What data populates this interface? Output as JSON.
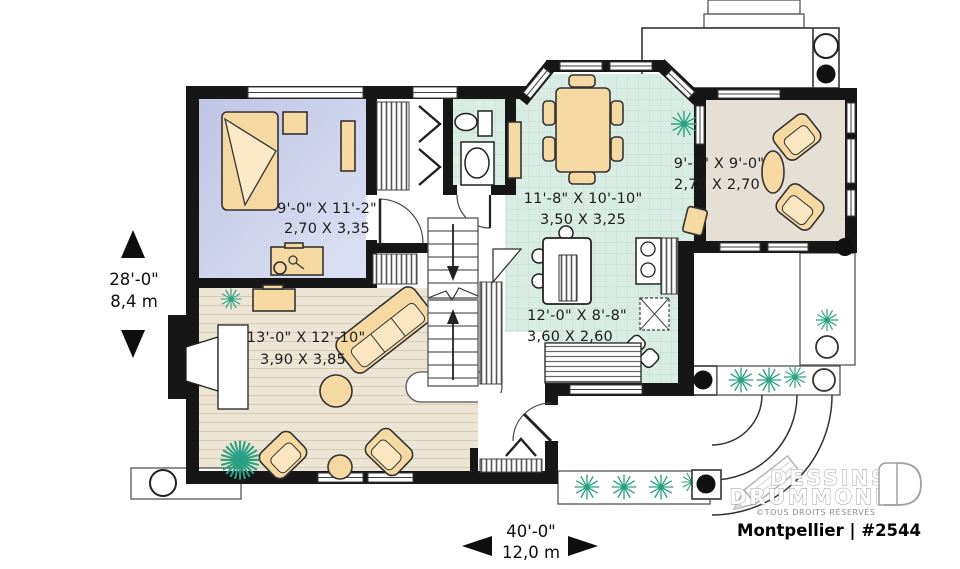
{
  "plan": {
    "title": "Montpellier | #2544",
    "brand": {
      "name_line1": "DESSINS",
      "name_line2": "DRUMMOND",
      "copyright": "©TOUS DROITS RÉSERVÉS"
    },
    "rooms": {
      "bedroom": {
        "imperial": "9'-0\" X 11'-2\"",
        "metric": "2,70 X 3,35"
      },
      "dining": {
        "imperial": "11'-8\" X 10'-10\"",
        "metric": "3,50 X 3,25"
      },
      "sunroom": {
        "imperial": "9'-0\" X 9'-0\"",
        "metric": "2,70 X 2,70"
      },
      "kitchen": {
        "imperial": "12'-0\" X 8'-8\"",
        "metric": "3,60 X 2,60"
      },
      "living": {
        "imperial": "13'-0\" X 12'-10\"",
        "metric": "3,90 X 3,85"
      }
    },
    "overall_dimensions": {
      "depth": {
        "imperial": "28'-0\"",
        "metric": "8,4 m"
      },
      "width": {
        "imperial": "40'-0\"",
        "metric": "12,0 m"
      }
    },
    "colors": {
      "wall": "#161616",
      "bedroom_floor": "#c7cce8",
      "tile_floor": "#d9ede4",
      "wood_floor": "#ece4d4",
      "sunroom_floor": "#e6dfd5",
      "furniture": "#f6d9a2",
      "plant": "#2aa183"
    }
  }
}
